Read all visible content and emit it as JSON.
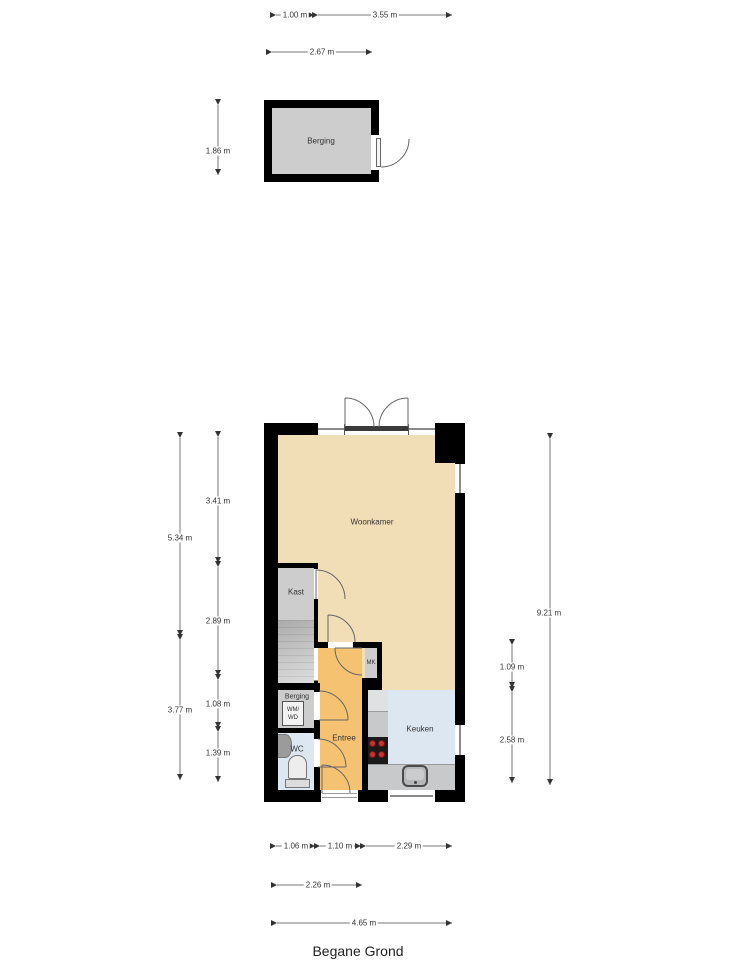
{
  "title": "Begane Grond",
  "shed": {
    "label": "Berging"
  },
  "rooms": {
    "woonkamer": "Woonkamer",
    "kast": "Kast",
    "berging": "Berging",
    "wc": "WC",
    "entree": "Entree",
    "mk": "MK",
    "keuken": "Keuken"
  },
  "fixtures": {
    "washer_line1": "WM/",
    "washer_line2": "WD"
  },
  "dims": {
    "d100": "1.00 m",
    "d355": "3.55 m",
    "d267": "2.67 m",
    "d186": "1.86 m",
    "d534": "5.34 m",
    "d377": "3.77 m",
    "d341": "3.41 m",
    "d289": "2.89 m",
    "d108": "1.08 m",
    "d139": "1.39 m",
    "d921": "9.21 m",
    "d109": "1.09 m",
    "d258": "2.58 m",
    "d106": "1.06 m",
    "d110": "1.10 m",
    "d229": "2.29 m",
    "d226": "2.26 m",
    "d465": "4.65 m"
  },
  "colors": {
    "wall": "#000000",
    "woonkamer": "#F2DEB6",
    "entree": "#F5C272",
    "keuken": "#DCE7F2",
    "room_gray": "#CDCDCD",
    "counter": "#C7C9CB",
    "stove": "#1A1A1A",
    "burner": "#C63434",
    "dimline": "#777777"
  }
}
